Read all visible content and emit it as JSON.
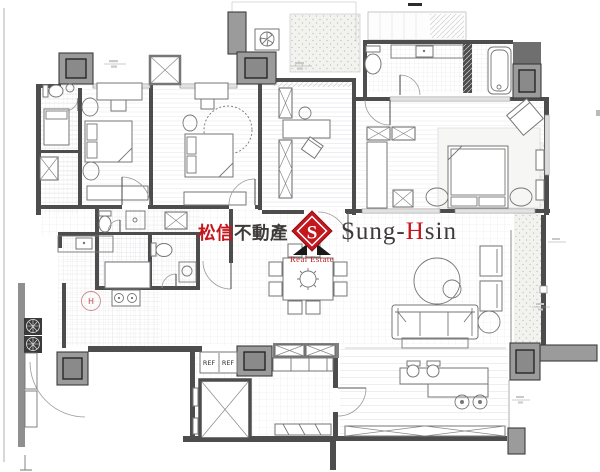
{
  "watermark": {
    "chinese_red": "松信",
    "chinese_dark": "不動產",
    "logo_letter": "S",
    "subtitle": "Real Estate",
    "name_part1": "Sung-",
    "name_accent": "H",
    "name_part2": "sin"
  },
  "labels": {
    "ref_left": "REF",
    "ref_right": "REF",
    "h_marker": "H"
  },
  "colors": {
    "wall": "#4d4d4d",
    "column": "#9b9b9b",
    "column_inner": "#8a8a8a",
    "accent_red": "#c4161d",
    "text_dark": "#3d3a39",
    "furniture_line": "#767676"
  }
}
